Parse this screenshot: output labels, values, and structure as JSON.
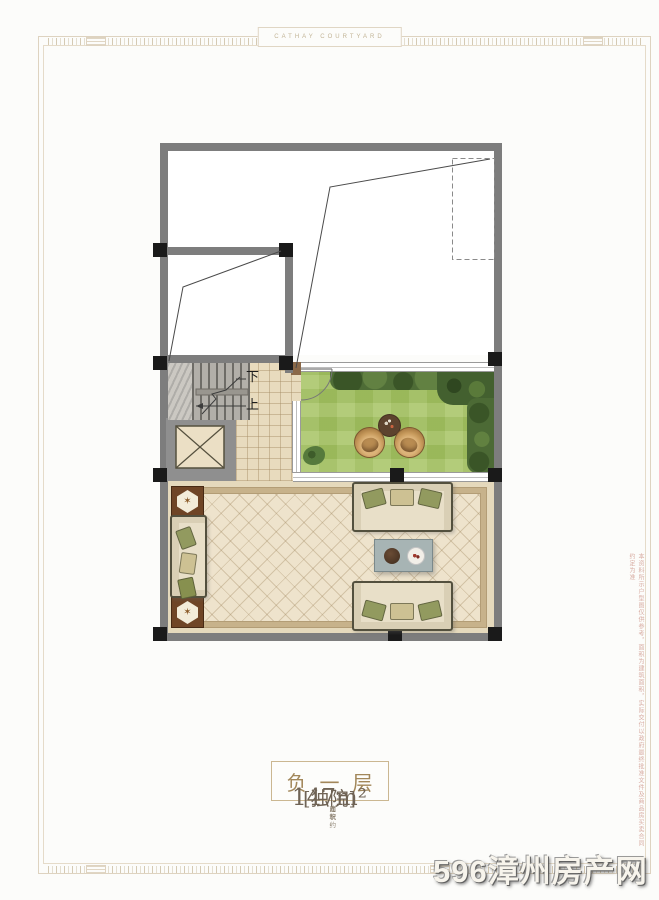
{
  "page": {
    "header_text": "CATHAY COURTYARD",
    "watermark_text": "596漳州房产网",
    "vertical_disclaimer": "本资料所示户型图仅供参考，面积为建筑面积，实际交付以政府最终批准文件及商品房买卖合同约定为准"
  },
  "plan": {
    "stair_label_down": "下",
    "stair_label_up": "上"
  },
  "caption": {
    "floor_title": "负一层",
    "unit_type": "[独院]",
    "area_note_top": "建筑",
    "area_note_bottom": "面积约",
    "area_value": "147m²"
  },
  "colors": {
    "accent_gold": "#a2875a",
    "text_brown": "#6f6355",
    "wall_gray": "#7d7d7d",
    "column_black": "#1a1a1a",
    "grass_green": "#a7c464",
    "shrub_green": "#4e6c36",
    "tile_beige": "#eee3cc",
    "band_tan": "#c7b28b",
    "frame_tan": "#ded3c0",
    "watermark_white": "#f7f4ec"
  }
}
